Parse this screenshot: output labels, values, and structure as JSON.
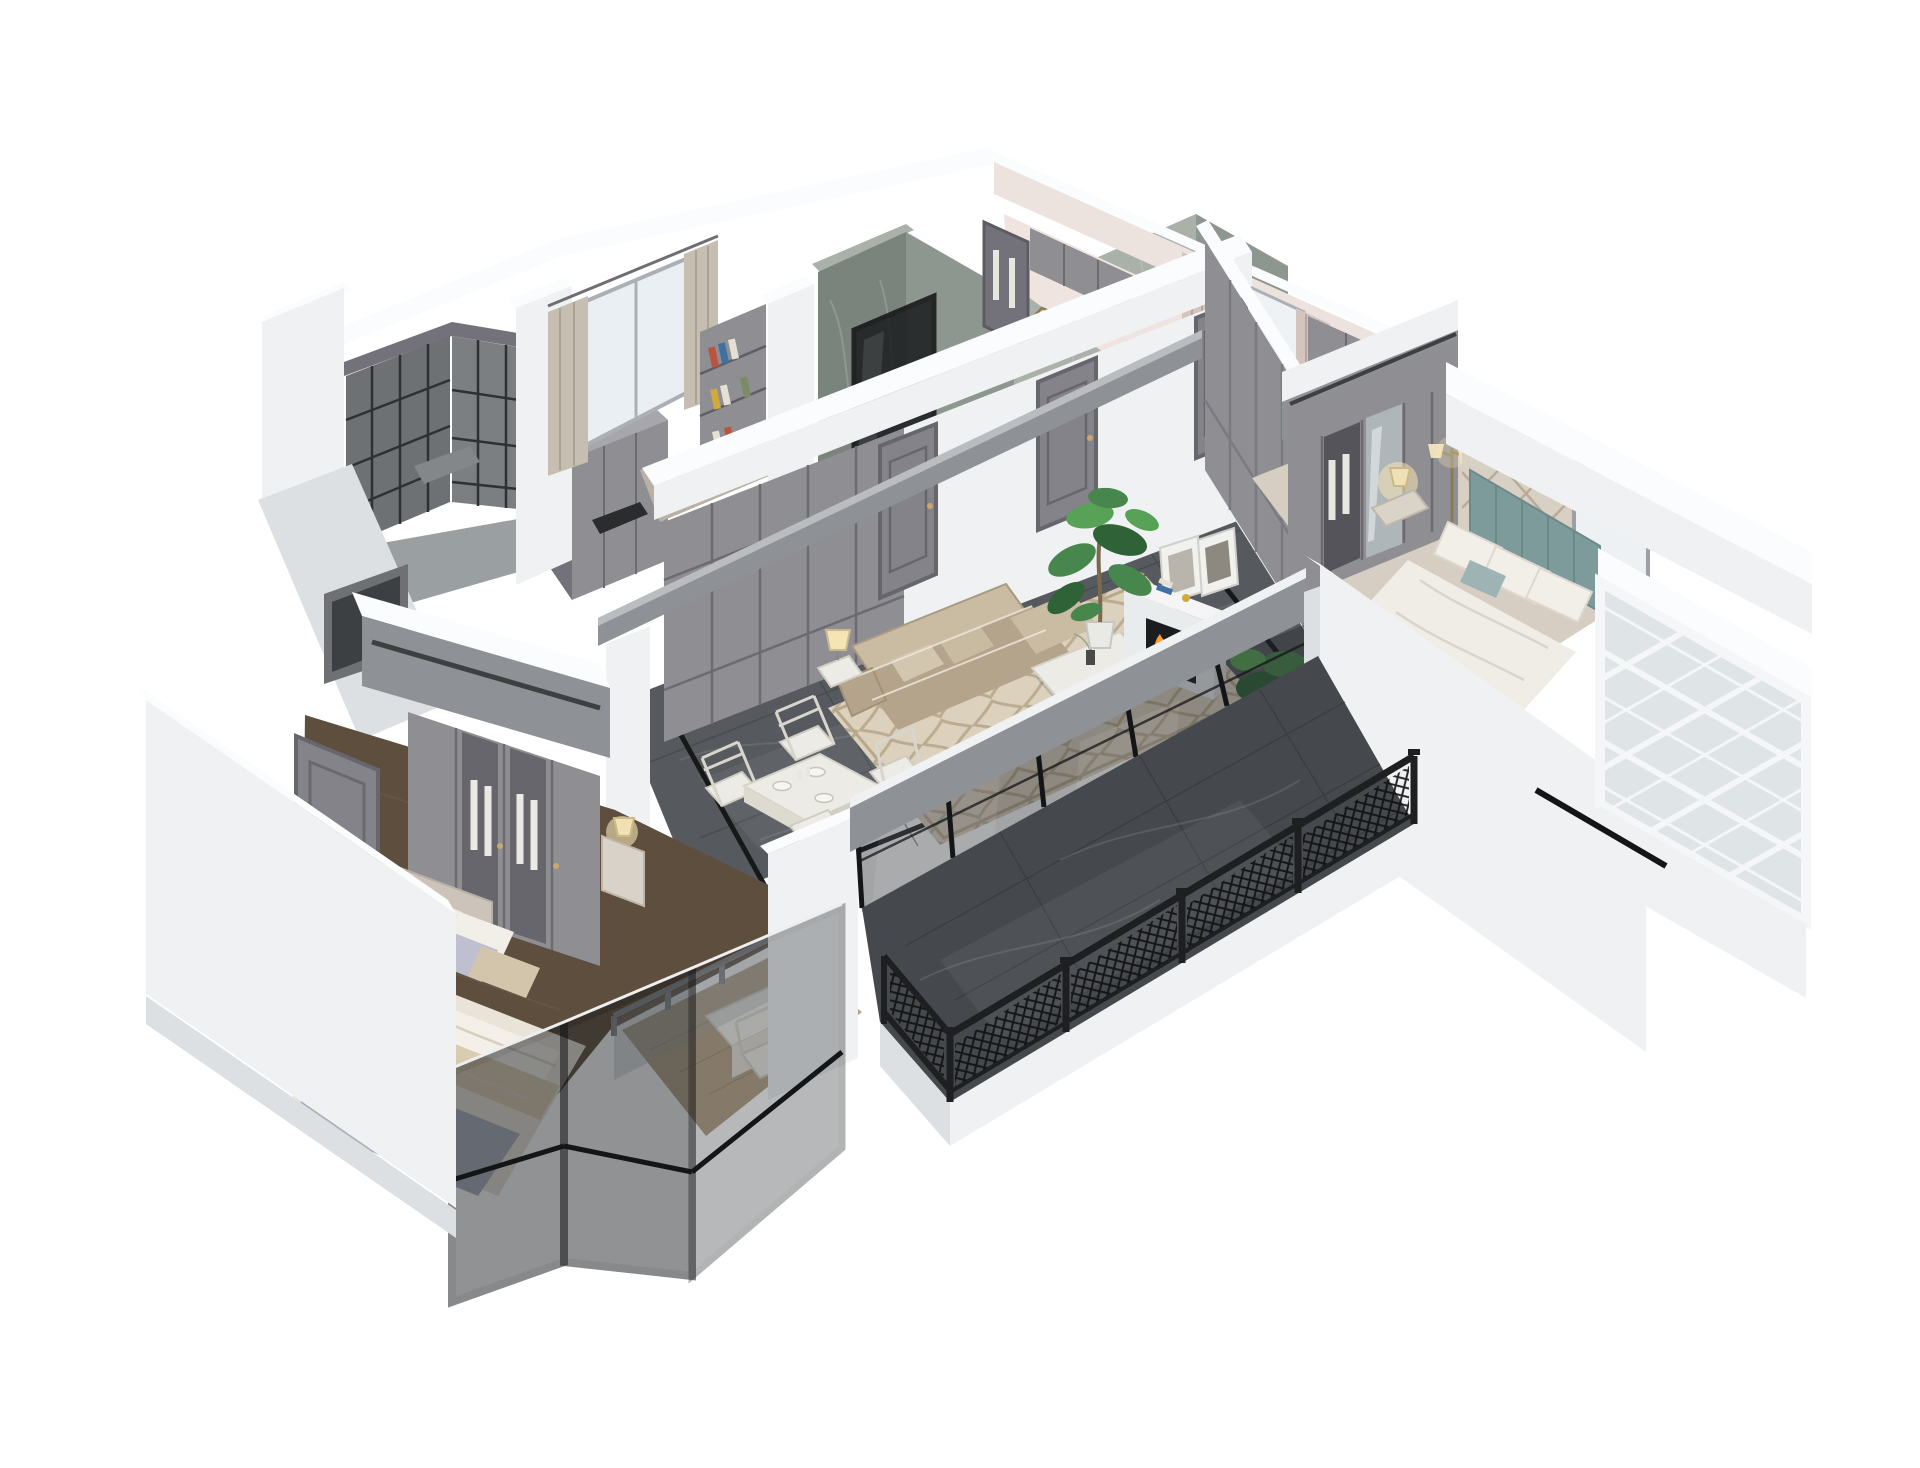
{
  "scene": {
    "type": "3D cutaway floor-plan render",
    "view": "isometric dollhouse view from above",
    "background": "#ffffff",
    "style": "transitional apartment: white cut walls, gray paneling, green-gray marble bath walls, dark marble floors, black metalwork"
  },
  "palette": {
    "bg": "#ffffff",
    "wallTop": "#fbfcfd",
    "wallFace": "#eff1f3",
    "wallShade": "#dde0e3",
    "wallDim": "#cfd2d6",
    "panelGray": "#8f8e93",
    "panelGrayDark": "#73727a",
    "panelGrayLight": "#a7a6ac",
    "doorGray": "#84838a",
    "marbleWall": "#8e978f",
    "marbleWallDark": "#7a837c",
    "marbleWallLight": "#a9b1a9",
    "floorMarble": "#565a5e",
    "floorMarbleDark": "#45484c",
    "floorVein": "#80868b",
    "inlayBlack": "#17181a",
    "frameBlack": "#141517",
    "beamGray": "#8e9296",
    "woodDark": "#5e4e3e",
    "woodLight": "#b5a389",
    "woodPole": "#7c6a4e",
    "rugBase": "#dbd1bd",
    "rugPattern": "#b7a88c",
    "sofaBeige": "#b5a48c",
    "sofaLight": "#cabba3",
    "tableWhite": "#ecebe5",
    "fireOrange": "#ff9b30",
    "fireYellow": "#ffd36e",
    "plantGreen": "#47864d",
    "plantDark": "#2f6237",
    "tealHeadboard": "#7e9b9c",
    "accentWall": "#d9d0c4",
    "accentLine": "#b9ab9a",
    "curtain": "#c7beb2",
    "curtainPink": "#d5c3bd",
    "pinkFloor": "#efe4e0",
    "lampGlow": "#f5e5b5",
    "glassDark": "#23272a",
    "bayGlass": "#dfe4e7",
    "accentRed": "#b9543f",
    "accentBlue": "#3f6fa3",
    "accentYellow": "#d2a93c",
    "brassGold": "#c9a86a"
  },
  "rooms": [
    {
      "id": "laundry-balcony",
      "label": "Service balcony with charcoal lattice screen windows",
      "features": [
        "fretwork screens",
        "gray counter block"
      ]
    },
    {
      "id": "study",
      "label": "Study with bookshelf and curtained window",
      "features": [
        "bookshelf with books",
        "sheer curtains",
        "bright window"
      ]
    },
    {
      "id": "bathroom",
      "label": "Bathroom block with green-gray marble walls",
      "features": [
        "marble wall slabs",
        "black framed glass shower partitions",
        "white parapet"
      ]
    },
    {
      "id": "dressing-room",
      "label": "Dressing room and laundry nook",
      "features": [
        "gray cabinets",
        "pink curtains",
        "glass wardrobe",
        "doormat"
      ]
    },
    {
      "id": "hallway",
      "label": "Hallway wall with built-in wardrobes and paneled doors",
      "features": [
        "gray built-in cabinet wall",
        "three gray paneled doors"
      ]
    },
    {
      "id": "living-dining",
      "label": "Open living and dining room",
      "features": [
        "dark marble floor with black inlay border",
        "cream trellis rug",
        "beige leather sofa",
        "white coffee table",
        "side table with lamp",
        "white fireplace with lit firebox",
        "leaning wall art",
        "potted monstera",
        "gray ceiling beam",
        "white dining table",
        "cross-back chairs",
        "place settings"
      ]
    },
    {
      "id": "master-bedroom",
      "label": "Master bedroom",
      "features": [
        "teal upholstered headboard",
        "diamond paneled accent wall",
        "white bedding",
        "nightstand with lit lamp",
        "floor lamp",
        "mirrored wardrobe",
        "gray soffit",
        "white fretwork bay window"
      ]
    },
    {
      "id": "second-bedroom",
      "label": "Second bedroom with desk balcony",
      "features": [
        "gray wardrobe with glass doors",
        "lavender and beige bedding",
        "nightstand with lit lamp",
        "gray entry door",
        "glass balustrade",
        "white desk and chair",
        "black framed glazing"
      ]
    },
    {
      "id": "front-balcony",
      "label": "Front balcony",
      "features": [
        "dark marble tiles",
        "black lattice railing",
        "black framed sliding glass wall",
        "white fascia"
      ]
    }
  ]
}
